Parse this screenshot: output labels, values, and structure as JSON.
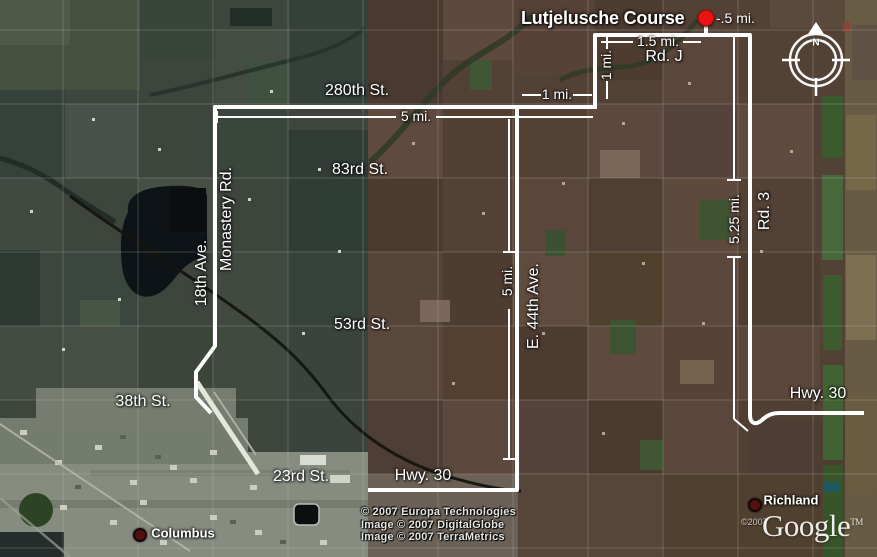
{
  "title": {
    "text": "Lutjelusche Course",
    "distance_label": "-.5 mi.",
    "marker_color": "#e81313"
  },
  "compass": {
    "north_label": "N"
  },
  "labels": [
    {
      "name": "label-280th-st",
      "text": "280th St.",
      "x": 357,
      "y": 91,
      "type": "road"
    },
    {
      "name": "label-83rd-st",
      "text": "83rd St.",
      "x": 360,
      "y": 170,
      "type": "road"
    },
    {
      "name": "label-53rd-st",
      "text": "53rd St.",
      "x": 362,
      "y": 325,
      "type": "road"
    },
    {
      "name": "label-38th-st",
      "text": "38th St.",
      "x": 143,
      "y": 402,
      "type": "road"
    },
    {
      "name": "label-23rd-st",
      "text": "23rd St.",
      "x": 301,
      "y": 477,
      "type": "road"
    },
    {
      "name": "label-hwy-30-south",
      "text": "Hwy. 30",
      "x": 423,
      "y": 476,
      "type": "road"
    },
    {
      "name": "label-hwy-30-east",
      "text": "Hwy. 30",
      "x": 818,
      "y": 394,
      "type": "road"
    },
    {
      "name": "label-rd-j",
      "text": "Rd. J",
      "x": 664,
      "y": 57,
      "type": "road"
    },
    {
      "name": "label-monastery-rd",
      "text": "Monastery Rd.",
      "x": 227,
      "y": 219,
      "type": "road",
      "vertical": true
    },
    {
      "name": "label-18th-ave",
      "text": "18th Ave.",
      "x": 202,
      "y": 273,
      "type": "road",
      "vertical": true
    },
    {
      "name": "label-e-44th-ave",
      "text": "E. 44th Ave.",
      "x": 534,
      "y": 306,
      "type": "road",
      "vertical": true
    },
    {
      "name": "label-rd-3",
      "text": "Rd. 3",
      "x": 765,
      "y": 211,
      "type": "road",
      "vertical": true
    },
    {
      "name": "measure-5-mi-horizontal",
      "text": "5 mi.",
      "x": 416,
      "y": 116,
      "type": "measure"
    },
    {
      "name": "measure-1-mi-horizontal",
      "text": "1 mi.",
      "x": 557,
      "y": 94,
      "type": "measure"
    },
    {
      "name": "measure-1-5-mi",
      "text": "1.5 mi.",
      "x": 658,
      "y": 41,
      "type": "measure"
    },
    {
      "name": "measure-1-mi-vertical",
      "text": "1 mi.",
      "x": 606,
      "y": 65,
      "type": "measure",
      "vertical": true
    },
    {
      "name": "measure-5-mi-vertical",
      "text": "5 mi.",
      "x": 507,
      "y": 281,
      "type": "measure",
      "vertical": true
    },
    {
      "name": "measure-5-25-mi",
      "text": "5.25 mi.",
      "x": 734,
      "y": 219,
      "type": "measure",
      "vertical": true
    }
  ],
  "places": [
    {
      "name": "place-columbus",
      "label": "Columbus",
      "text_x": 183,
      "text_y": 533,
      "dot_x": 140,
      "dot_y": 535
    },
    {
      "name": "place-richland",
      "label": "Richland",
      "text_x": 791,
      "text_y": 500,
      "dot_x": 755,
      "dot_y": 505
    }
  ],
  "attribution": {
    "lines": [
      "© 2007 Europa Technologies",
      "Image © 2007 DigitalGlobe",
      "Image © 2007 TerraMetrics"
    ]
  },
  "watermark": {
    "copyright": "©2007",
    "brand": "Google",
    "tm": "TM"
  },
  "colors": {
    "route_line": "#ffffff",
    "marker_red": "#e81313",
    "place_dot": "#521111",
    "terrain_left": "#3d453d",
    "terrain_right": "#534136"
  }
}
